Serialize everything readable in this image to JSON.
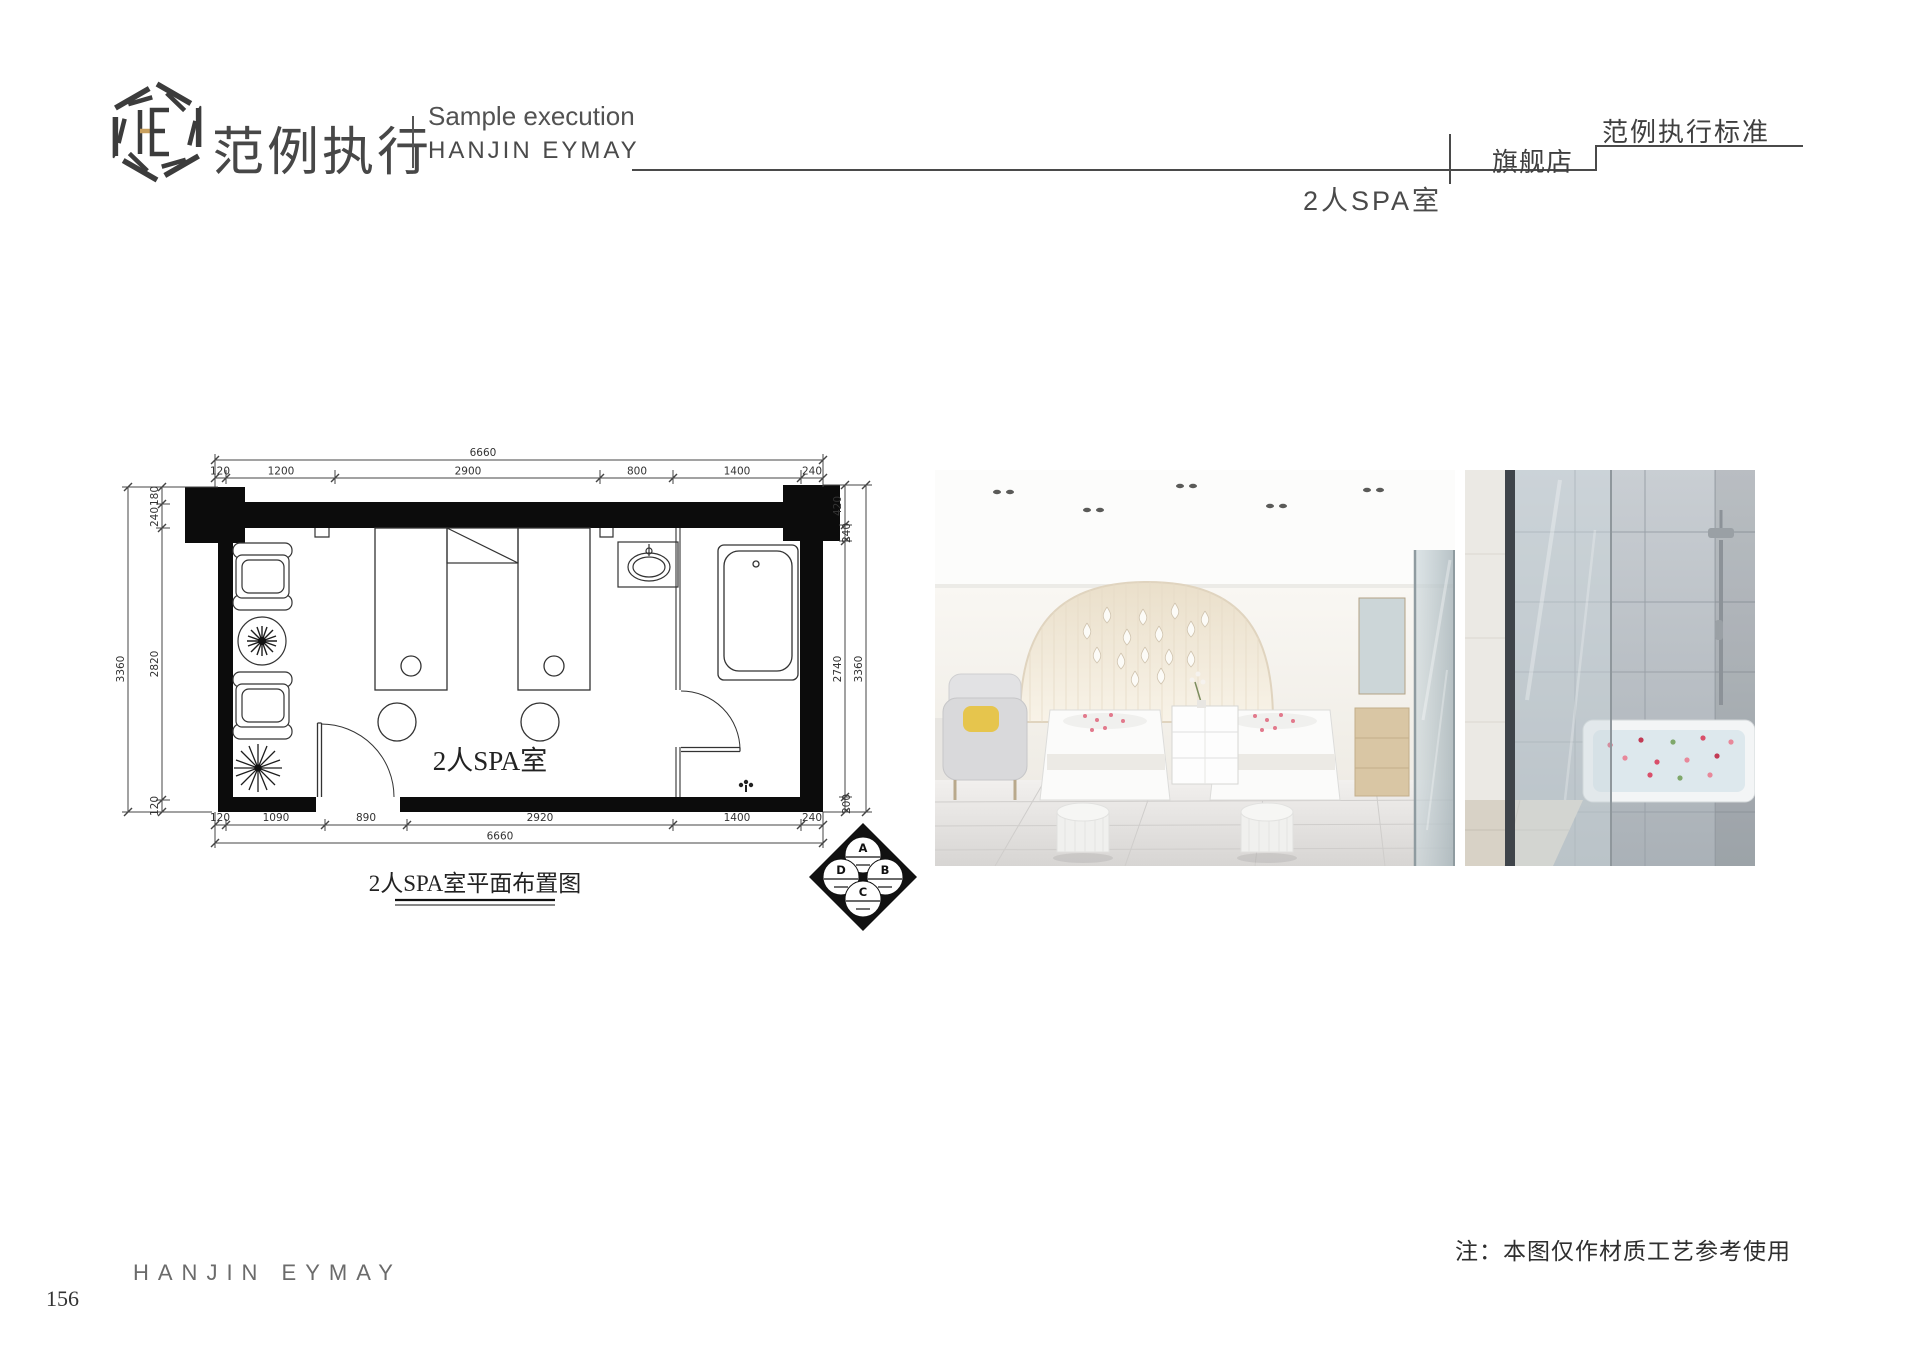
{
  "header": {
    "logo_monogram": "HE",
    "brand_cn": "范例执行",
    "tagline_en": "Sample execution",
    "brand_en": "HANJIN EYMAY",
    "standard_label": "范例执行标准",
    "store_label": "旗舰店",
    "page_subject": "2人SPA室"
  },
  "plan": {
    "room_label": "2人SPA室",
    "caption": "2人SPA室平面布置图",
    "dims": {
      "top_total": "6660",
      "top": [
        "120",
        "1200",
        "2900",
        "800",
        "1400",
        "240"
      ],
      "bottom": [
        "120",
        "1090",
        "890",
        "2920",
        "1400",
        "240"
      ],
      "bottom_total": "6660",
      "left": [
        "180",
        "240",
        "2820",
        "120"
      ],
      "left_total": "3360",
      "right": [
        "420",
        "240",
        "2740",
        "200"
      ],
      "right_total": "3360"
    },
    "elevation_marker": {
      "top": "A",
      "right": "B",
      "bottom": "C",
      "left": "D"
    }
  },
  "footer": {
    "note": "注：本图仅作材质工艺参考使用",
    "brand_en": "HANJIN EYMAY",
    "page_number": "156"
  },
  "colors": {
    "ink": "#3f3f3f",
    "gold_accent": "#c9a05e",
    "line": "#4a4a4a"
  }
}
